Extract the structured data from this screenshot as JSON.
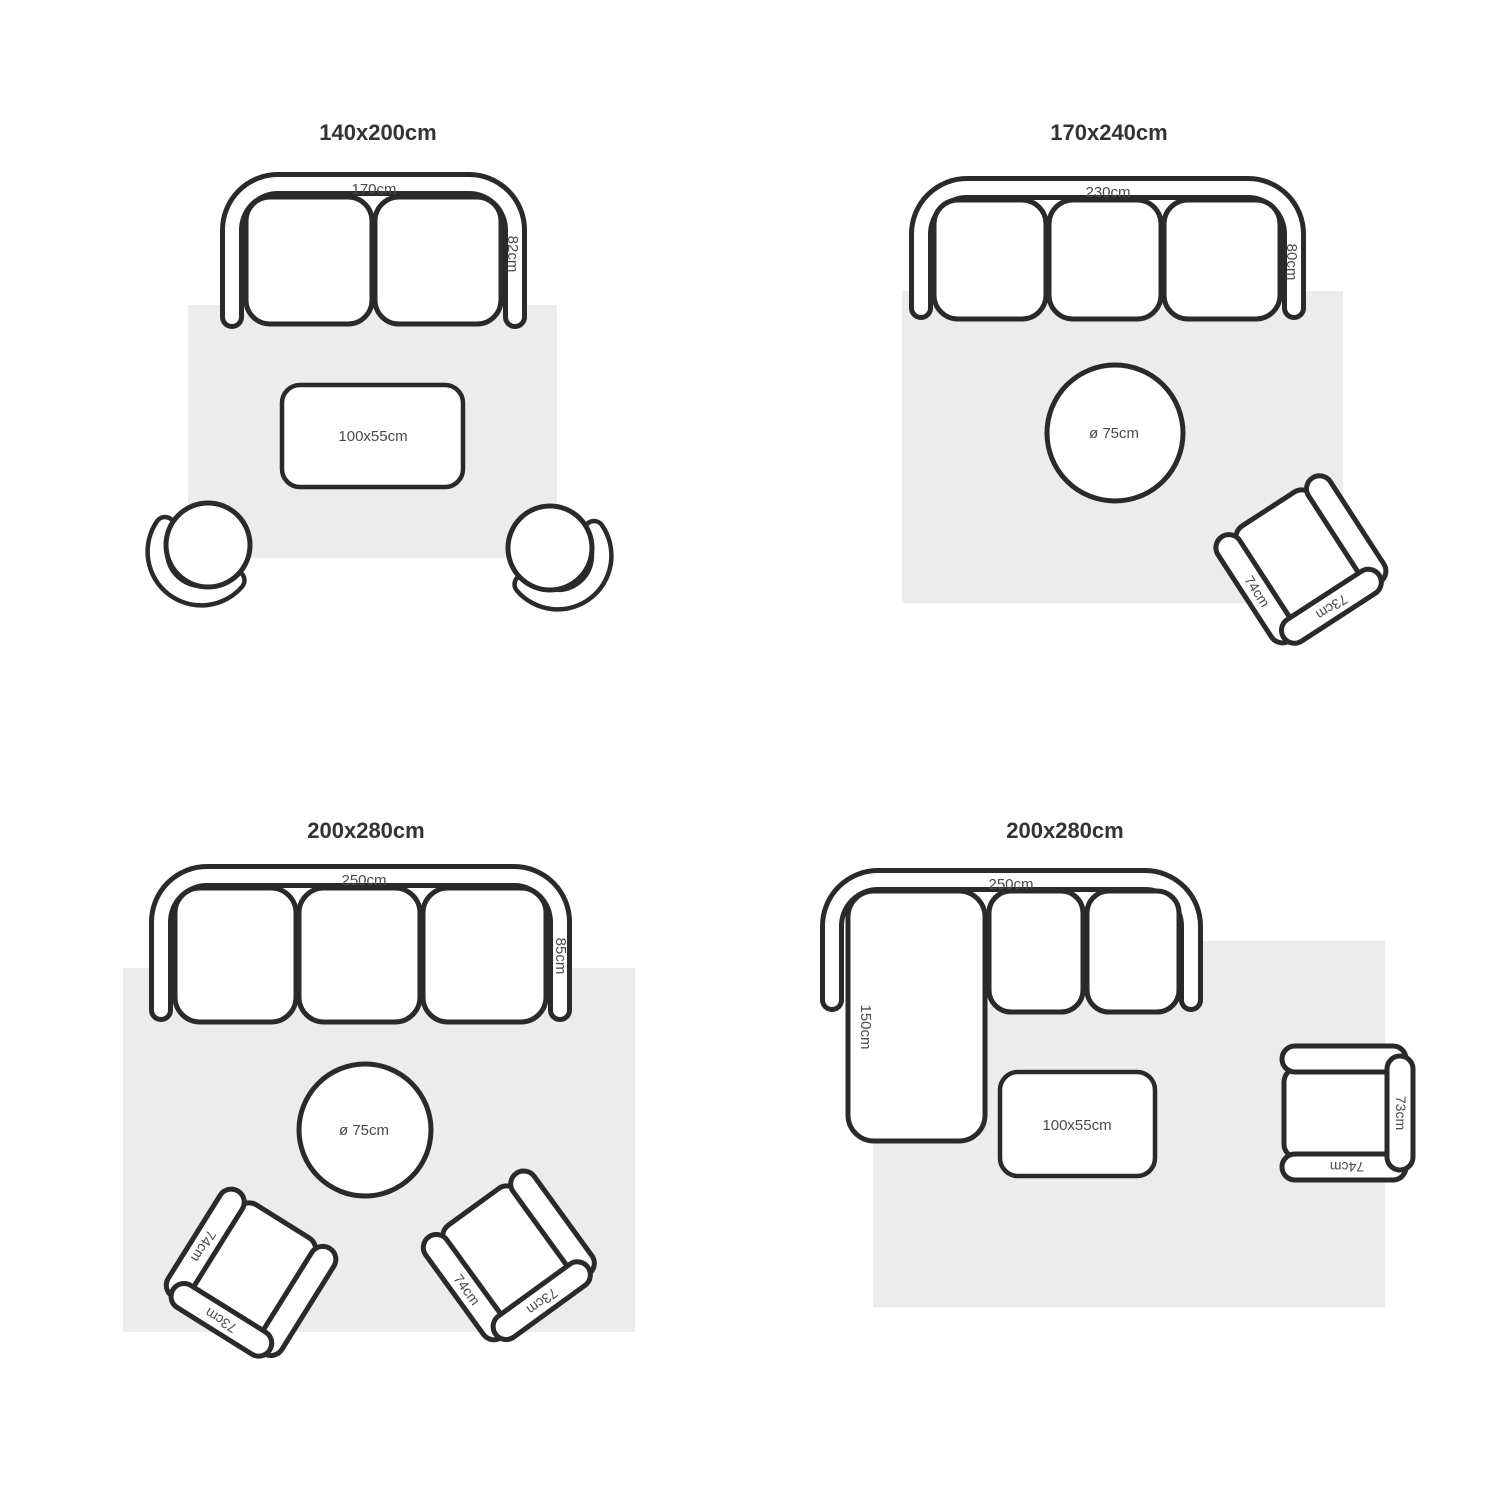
{
  "colors": {
    "outline": "#2b2a28",
    "rug": "#ececec",
    "dimension_text": "#4a4a4a",
    "title_text": "#333333",
    "background": "#ffffff"
  },
  "quadrants": [
    {
      "id": "top-left",
      "title": "140x200cm",
      "sofa": {
        "seats": 2,
        "width": "170cm",
        "depth": "82cm"
      },
      "coffee_table": {
        "size": "100x55cm"
      }
    },
    {
      "id": "top-right",
      "title": "170x240cm",
      "sofa": {
        "seats": 3,
        "width": "230cm",
        "depth": "80cm"
      },
      "round_table": {
        "size": "ø 75cm"
      },
      "armchair": {
        "side": "74cm",
        "back": "73cm"
      }
    },
    {
      "id": "bottom-left",
      "title": "200x280cm",
      "sofa": {
        "seats": 3,
        "width": "250cm",
        "depth": "85cm"
      },
      "round_table": {
        "size": "ø 75cm"
      },
      "armchairs": [
        {
          "side": "74cm",
          "back": "73cm"
        },
        {
          "side": "74cm",
          "back": "73cm"
        }
      ]
    },
    {
      "id": "bottom-right",
      "title": "200x280cm",
      "sofa": {
        "seats": 2,
        "width": "250cm",
        "chaise_length": "150cm"
      },
      "coffee_table": {
        "size": "100x55cm"
      },
      "armchair": {
        "side": "74cm",
        "back": "73cm"
      }
    }
  ]
}
